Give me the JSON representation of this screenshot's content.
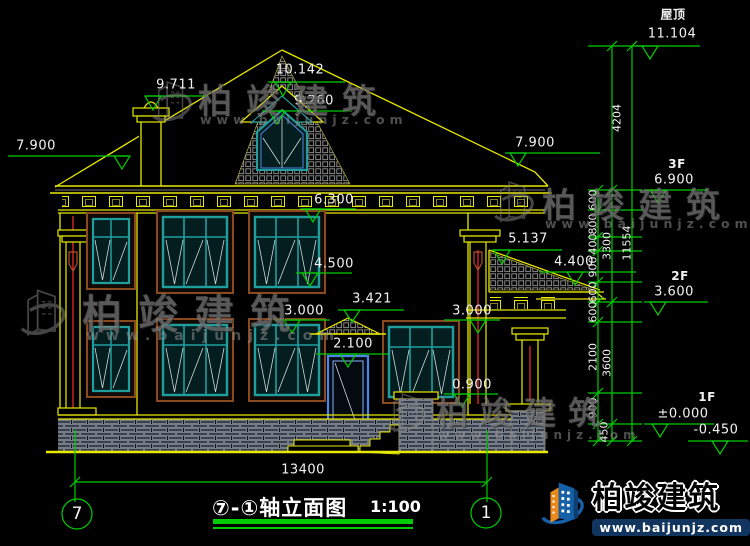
{
  "colors": {
    "background": "#000000",
    "line_yellow": "#e8e800",
    "dim_green": "#00cd00",
    "window_teal": "#1f9e9e",
    "trim_brown": "#8a4a20",
    "door_blue": "#4a86e8",
    "accent_red": "#ff2a2a",
    "text_white": "#f2f2f2",
    "logo_blue": "#1660a8",
    "logo_orange": "#e8891d"
  },
  "marks": {
    "chimney_top": "9.711",
    "ridge": "10.142",
    "dormer_eave": "9.260",
    "eave_left": "7.900",
    "eave_right": "7.900",
    "cornice": "6.300",
    "sill_2f": "4.500",
    "canopy": "3.421",
    "level_left": "3.000",
    "level_right": "3.000",
    "door_head": "2.100",
    "sill_1f": "0.900",
    "porch_ridge": "5.137",
    "porch_eave": "4.400"
  },
  "levels": {
    "roof_label": "屋顶",
    "roof_value": "11.104",
    "f3_label": "3F",
    "f3_value": "6.900",
    "f2_label": "2F",
    "f2_value": "3.600",
    "f1_label": "1F",
    "f1_value": "±0.000",
    "below_value": "-0.450"
  },
  "dims": {
    "chain": [
      "600",
      "800",
      "400",
      "900",
      "600",
      "600",
      "2100",
      "900",
      "450"
    ],
    "groups": [
      "4204",
      "3300",
      "3600"
    ],
    "total": "11554",
    "width": "13400"
  },
  "axes": {
    "left": "7",
    "right": "1"
  },
  "title": {
    "label": "⑦-①轴立面图",
    "scale": "1:100"
  },
  "watermark": {
    "brand": "柏竣建筑",
    "url": "www.baijunjz.com"
  }
}
